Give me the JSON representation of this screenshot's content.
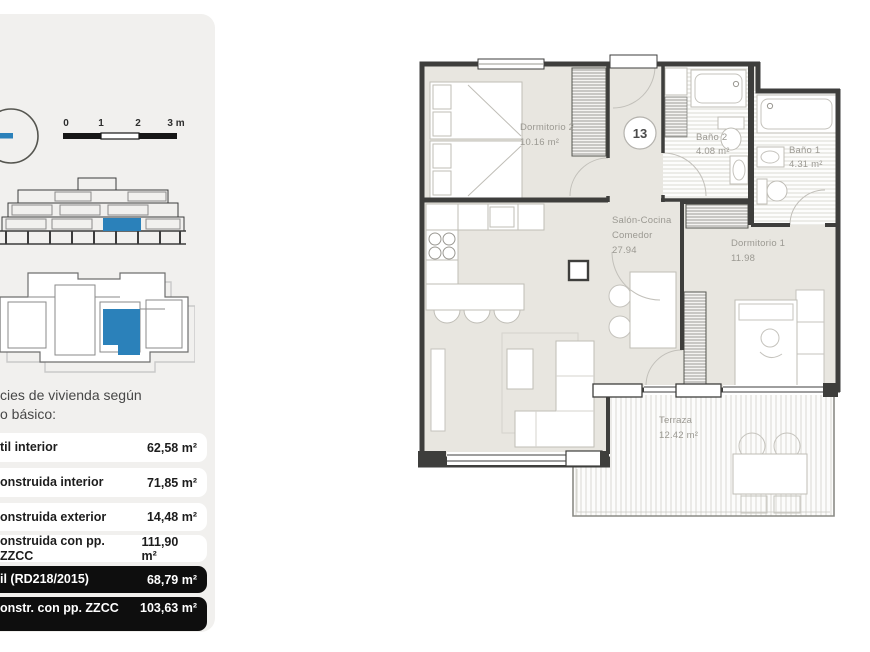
{
  "sidebar": {
    "scalebar": {
      "tick0": "0",
      "tick1": "1",
      "tick2": "2",
      "tick3": "3 m"
    },
    "heading_line1": "cies de vivienda según",
    "heading_line2": "o básico:",
    "rows": [
      {
        "label": "til interior",
        "value": "62,58 m²"
      },
      {
        "label": "onstruida interior",
        "value": "71,85 m²"
      },
      {
        "label": "onstruida exterior",
        "value": "14,48 m²"
      },
      {
        "label": "onstruida con pp. ZZCC",
        "value": "111,90 m²"
      },
      {
        "label": "il (RD218/2015)",
        "value": "68,79 m²"
      },
      {
        "label": "onstr. con pp. ZZCC",
        "label_line2": "8/2015)",
        "value": "103,63 m²"
      }
    ]
  },
  "floorplan": {
    "unit_badge": "13",
    "rooms": {
      "dormitorio2": {
        "name": "Dormitorio 2",
        "area": "10.16 m²"
      },
      "bano2": {
        "name": "Baño 2",
        "area": "4.08 m²"
      },
      "bano1": {
        "name": "Baño 1",
        "area": "4.31 m²"
      },
      "salon": {
        "name": "Salón-Cocina",
        "name_line2": "Comedor",
        "area": "27.94"
      },
      "dormitorio1": {
        "name": "Dormitorio 1",
        "area": "11.98"
      },
      "terraza": {
        "name": "Terraza",
        "area": "12.42 m²"
      }
    }
  },
  "colors": {
    "accent_blue": "#2b81ba",
    "wall": "#3e3e3c",
    "floor": "#e8e6e0"
  }
}
